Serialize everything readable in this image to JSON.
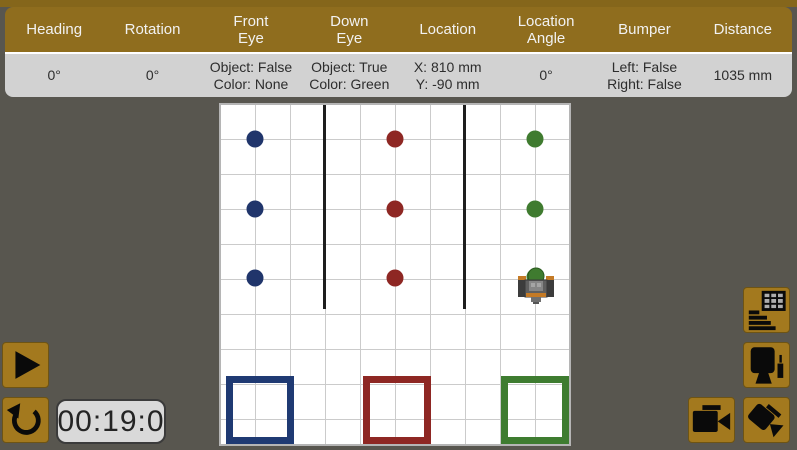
{
  "colors": {
    "gold": "#8F6D1E",
    "gold_button": "#A3791E",
    "background": "#58564F",
    "panel_gray": "#D2D2D2",
    "dot_blue": "#20356B",
    "dot_red": "#8E2723",
    "dot_green": "#3F7B2F",
    "square_blue": "#1F3A73",
    "square_red": "#8E2723",
    "square_green": "#3E7C30"
  },
  "header": {
    "columns": [
      {
        "label": "Heading",
        "value": "0°"
      },
      {
        "label": "Rotation",
        "value": "0°"
      },
      {
        "label": "Front\nEye",
        "value": "Object: False\nColor: None"
      },
      {
        "label": "Down\nEye",
        "value": "Object: True\nColor: Green"
      },
      {
        "label": "Location",
        "value": "X: 810 mm\nY: -90 mm"
      },
      {
        "label": "Location\nAngle",
        "value": "0°"
      },
      {
        "label": "Bumper",
        "value": "Left: False\nRight: False"
      },
      {
        "label": "Distance",
        "value": "1035 mm"
      }
    ]
  },
  "controls": {
    "timer": "00:19:0",
    "icons": {
      "play": "play-icon",
      "reset": "counterclockwise-arrow-icon",
      "data_table": "table-and-bars-icon",
      "monitor": "monitor-and-marker-icon",
      "video_camera": "video-camera-icon",
      "camera_tilted": "tilted-video-camera-icon"
    }
  },
  "field": {
    "balls": [
      {
        "color": "blue",
        "column": 1,
        "row": 1
      },
      {
        "color": "blue",
        "column": 1,
        "row": 2
      },
      {
        "color": "blue",
        "column": 1,
        "row": 3
      },
      {
        "color": "red",
        "column": 2,
        "row": 1
      },
      {
        "color": "red",
        "column": 2,
        "row": 2
      },
      {
        "color": "red",
        "column": 2,
        "row": 3
      },
      {
        "color": "green",
        "column": 3,
        "row": 1
      },
      {
        "color": "green",
        "column": 3,
        "row": 2
      },
      {
        "color": "green",
        "column": 3,
        "row": 3
      }
    ],
    "target_squares": [
      "blue",
      "red",
      "green"
    ],
    "robot": {
      "present": true,
      "at_ball": "green row 3"
    }
  }
}
